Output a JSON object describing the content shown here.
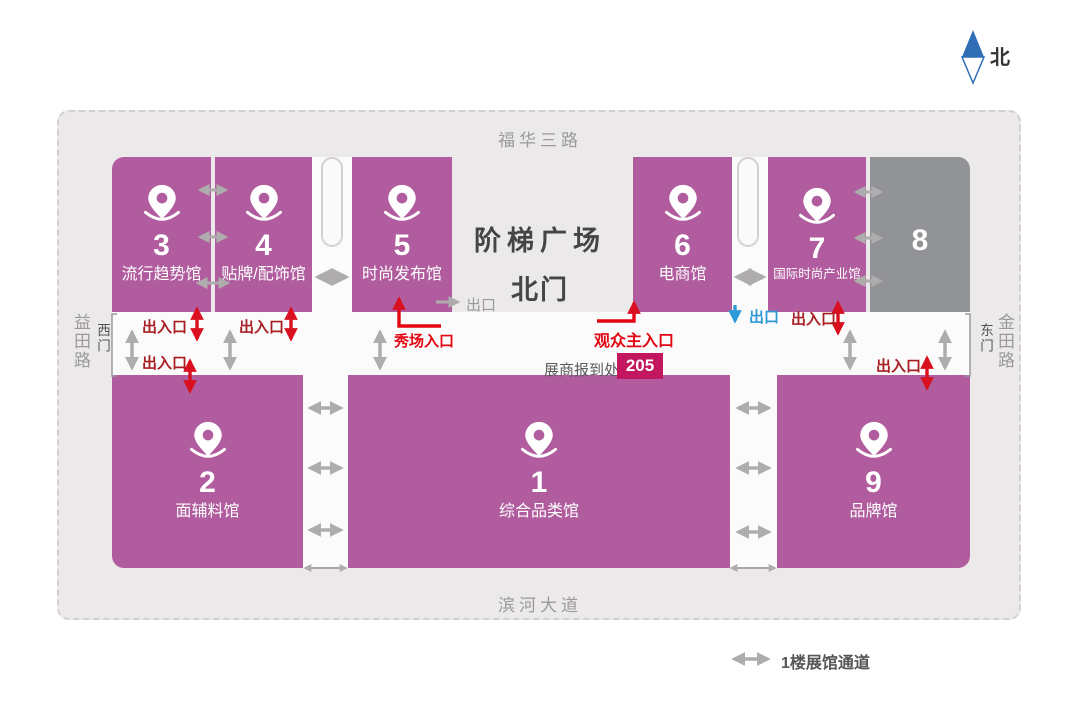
{
  "page": {
    "north": "北",
    "legend_passage": "1楼展馆通道"
  },
  "map": {
    "roads": {
      "top": "福华三路",
      "bottom": "滨河大道",
      "left": "益田路",
      "right": "金田路"
    },
    "gates": {
      "west": "西门",
      "east": "东门",
      "north_gate": "北门",
      "plaza": "阶梯广场"
    },
    "labels": {
      "entrance_exit": "出入口",
      "exit": "出口",
      "show_entrance": "秀场入口",
      "audience_main_entrance": "观众主入口",
      "exhibitor_checkin": "展商报到处",
      "checkin_room": "205"
    },
    "halls": [
      {
        "number": "3",
        "name": "流行趋势馆"
      },
      {
        "number": "4",
        "name": "贴牌/配饰馆"
      },
      {
        "number": "5",
        "name": "时尚发布馆"
      },
      {
        "number": "6",
        "name": "电商馆"
      },
      {
        "number": "7",
        "name": "国际时尚产业馆"
      },
      {
        "number": "8",
        "name": ""
      },
      {
        "number": "2",
        "name": "面辅料馆"
      },
      {
        "number": "1",
        "name": "综合品类馆"
      },
      {
        "number": "9",
        "name": "品牌馆"
      }
    ],
    "colors": {
      "hall": "#b05c9e",
      "hall_inactive": "#919396",
      "red": "#d9101f",
      "dark_red_text": "#a81e23",
      "blue": "#2e9bd6",
      "badge": "#c2175f",
      "passage_arrow": "#aeacac"
    }
  }
}
